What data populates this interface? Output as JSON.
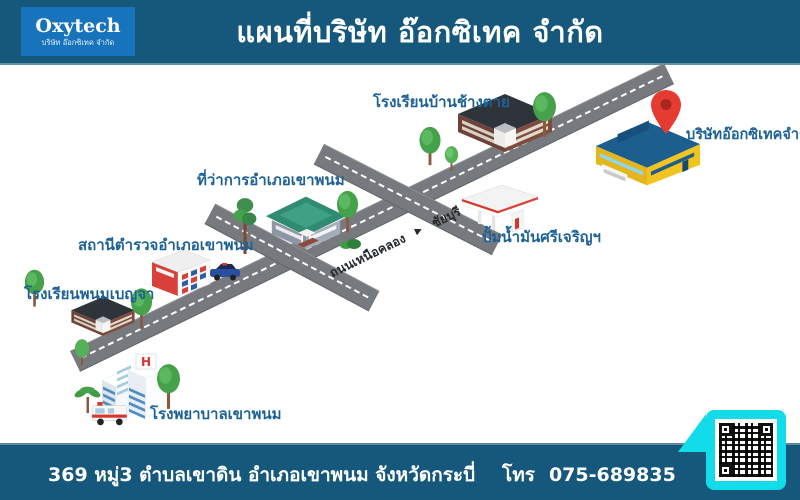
{
  "header": {
    "logo_title": "Oxytech",
    "logo_subtitle": "บริษัท อ๊อกซิเทค จำกัด",
    "title": "แผนที่บริษัท อ๊อกซิเทค จำกัด"
  },
  "map": {
    "road": {
      "from": "ถนนเหนือคลอง",
      "arrow": "▶",
      "to": "ชัยบุรี"
    },
    "places": [
      {
        "id": "school-changtai",
        "label": "โรงเรียนบ้านช้างตาย"
      },
      {
        "id": "oxytech-company",
        "label": "บริษัทอ๊อกซิเทคจำกัด"
      },
      {
        "id": "district-office",
        "label": "ที่ว่าการอำเภอเขาพนม"
      },
      {
        "id": "gas-station",
        "label": "ปั้มน้ำมันศรีเจริญฯ"
      },
      {
        "id": "police-station",
        "label": "สถานีตำรวจอำเภอเขาพนม"
      },
      {
        "id": "school-benja",
        "label": "โรงเรียนพนมเบญจา"
      },
      {
        "id": "hospital",
        "label": "โรงพยาบาลเขาพนม"
      }
    ],
    "hospital_sign": "H"
  },
  "footer": {
    "address": "369 หมู่3 ตำบลเขาดิน อำเภอเขาพนม จังหวัดกระบี่",
    "phone_label": "โทร",
    "phone_number": "075-689835"
  },
  "colors": {
    "bar_background": "#15587B",
    "logo_background": "#1673BC",
    "label_blue": "#1E6295",
    "road_gray": "#76797D",
    "accent_cyan": "#12DCEA",
    "pin_red": "#E63B30"
  }
}
